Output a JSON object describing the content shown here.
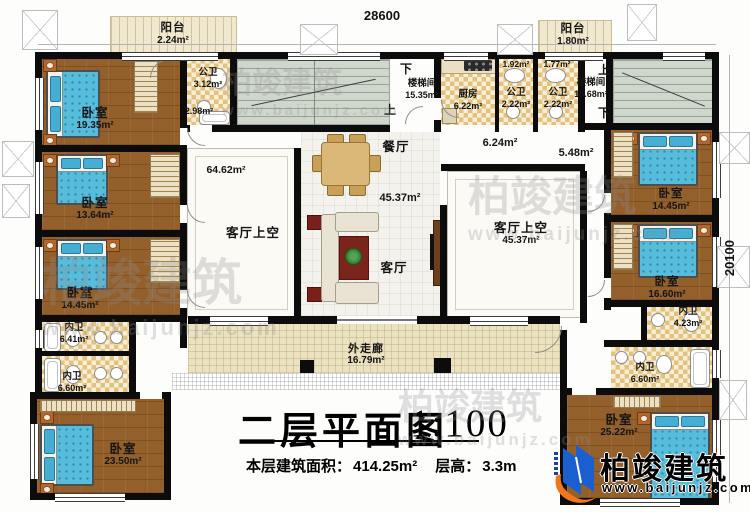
{
  "dimensions": {
    "top": "28600",
    "right": "20100"
  },
  "stair_left": {
    "down": "下",
    "name": "楼梯间",
    "area": "15.35m²",
    "up": "上"
  },
  "stair_right": {
    "up": "上",
    "name": "楼梯间",
    "area": "15.68m²",
    "down": "下"
  },
  "rooms": {
    "balcony_tl": {
      "name": "阳台",
      "area": "2.24m²"
    },
    "bedroom_l1": {
      "name": "卧室",
      "area": "19.35m²"
    },
    "bath_tl": {
      "name": "公卫",
      "area": "3.12m²",
      "sub": "2.98m²"
    },
    "bedroom_l2": {
      "name": "卧室",
      "area": "13.64m²"
    },
    "bedroom_l3": {
      "name": "卧室",
      "area": "14.45m²"
    },
    "bath_l1": {
      "name": "内卫",
      "area": "6.41m²"
    },
    "bath_l2": {
      "name": "内卫",
      "area": "6.60m²"
    },
    "bedroom_l4": {
      "name": "卧室",
      "area": "23.50m²"
    },
    "kitchen": {
      "name": "厨房",
      "area": "6.22m²"
    },
    "pbath1": {
      "name": "公卫",
      "area": "2.22m²",
      "vest": "1.92m²"
    },
    "pbath2": {
      "name": "公卫",
      "area": "2.22m²",
      "vest": "1.77m²"
    },
    "balcony_tr": {
      "name": "阳台",
      "area": "1.80m²"
    },
    "hall_a": {
      "area": "6.24m²"
    },
    "hall_b": {
      "area": "5.48m²"
    },
    "dining": {
      "name": "餐厅"
    },
    "hall_main": {
      "area": "45.37m²"
    },
    "living": {
      "name": "客厅"
    },
    "void_left": {
      "name": "客厅上空",
      "area": "64.62m²"
    },
    "void_right": {
      "name": "客厅上空",
      "area": "45.37m²"
    },
    "bedroom_r1": {
      "name": "卧室",
      "area": "14.45m²"
    },
    "bedroom_r2": {
      "name": "卧室",
      "area": "16.60m²"
    },
    "bath_r1": {
      "name": "内卫",
      "area": "4.23m²"
    },
    "bath_r2": {
      "name": "内卫",
      "area": "6.60m²"
    },
    "bedroom_r3": {
      "name": "卧室",
      "area": "25.22m²"
    },
    "corridor": {
      "name": "外走廊",
      "area": "16.79m²"
    }
  },
  "title_block": {
    "title": "二层平面图",
    "scale": "1:100",
    "area_label": "本层建筑面积：",
    "area_value": "414.25m²",
    "height_label": "层高：",
    "height_value": "3.3m"
  },
  "logo": {
    "name": "柏竣建筑",
    "url": "www.baijunjz.com"
  },
  "watermark": {
    "brand": "柏竣建筑",
    "url": "www.baijunjz.com"
  }
}
